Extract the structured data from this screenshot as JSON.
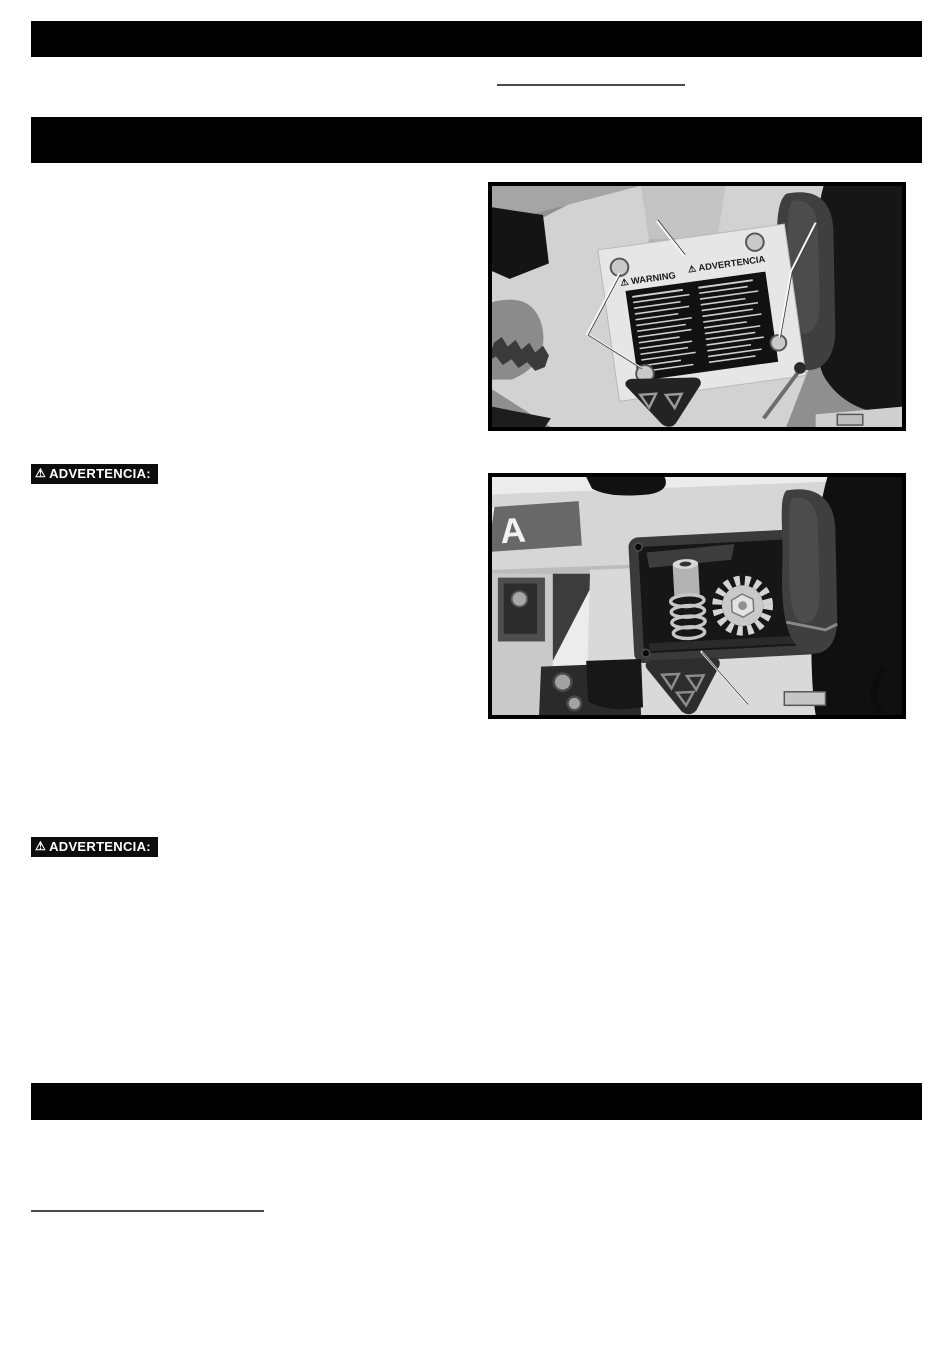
{
  "page": {
    "background": "#ffffff"
  },
  "colors": {
    "section_bar": "#000000",
    "underline": "#4a4a4a",
    "badge_background": "#0d0d0d",
    "badge_text": "#ffffff",
    "photo_frame": "#000000"
  },
  "icons": {
    "warning_triangle": "⚠"
  },
  "badges": [
    {
      "icon": "⚠",
      "label": "ADVERTENCIA:"
    },
    {
      "icon": "⚠",
      "label": "ADVERTENCIA:"
    }
  ],
  "figure1": {
    "description": "machine arm with warning label plate attached by screws",
    "label_title_en": "WARNING",
    "label_title_es": "ADVERTENCIA",
    "label_icon": "⚠"
  },
  "figure2": {
    "description": "open access cover showing spring and elevating gear",
    "logo_letter": "A"
  }
}
